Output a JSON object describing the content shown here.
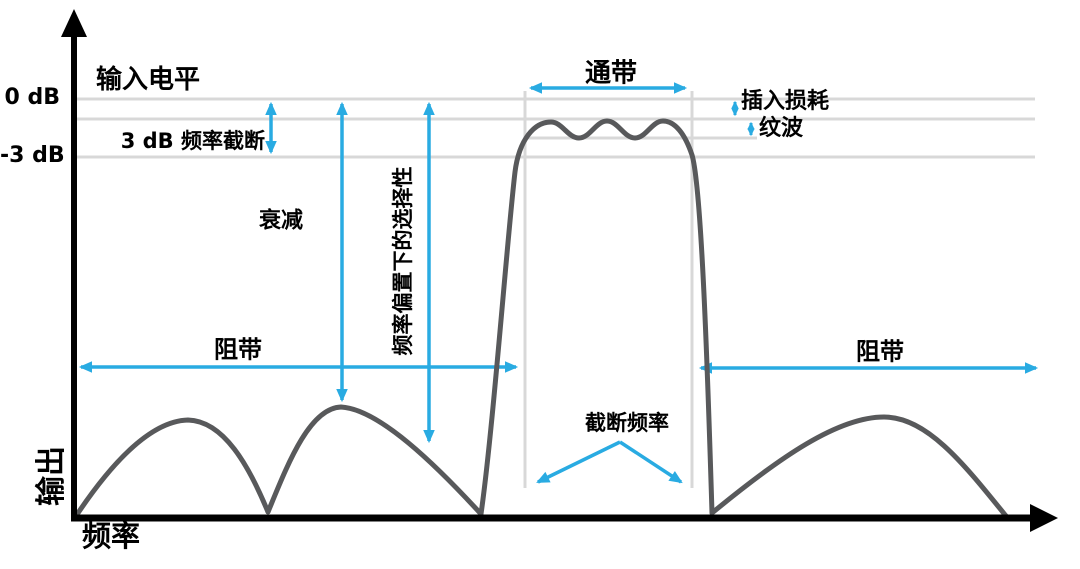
{
  "diagram": {
    "type": "bandpass-filter-frequency-response",
    "y_axis_label": "输出",
    "x_axis_label": "频率",
    "ticks": {
      "zero_db": "0 dB",
      "minus_three_db": "-3 dB"
    },
    "labels": {
      "input_level": "输入电平",
      "cutoff_3db": "3 dB 频率截断",
      "attenuation": "衰减",
      "selectivity": "频率偏置下的选择性",
      "passband": "通带",
      "insertion_loss": "插入损耗",
      "ripple": "纹波",
      "stopband_left": "阻带",
      "stopband_right": "阻带",
      "cutoff_frequency": "截断频率"
    },
    "levels": {
      "reference_db": 0,
      "cutoff_db": -3
    },
    "colors": {
      "annotation": "#29ABE2",
      "curve": "#58595B",
      "gridline": "#D8D8D8",
      "axis": "#000000",
      "background": "#FFFFFF"
    }
  }
}
